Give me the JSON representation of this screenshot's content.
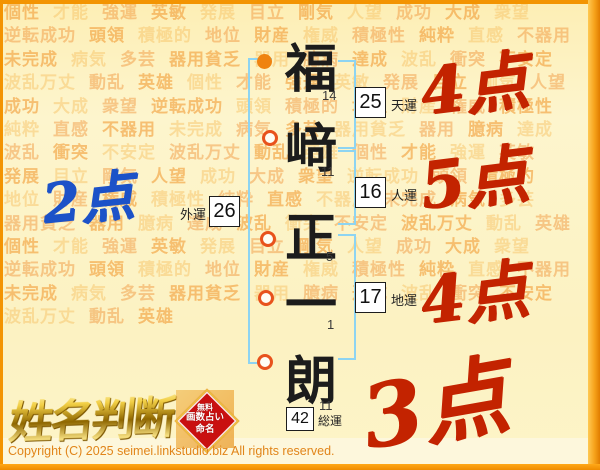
{
  "page": {
    "accent_orange": "#f39402",
    "bracket_blue": "#8dd4f2",
    "score_red": "#c32300",
    "score_blue": "#1c52c8",
    "seal_red": "#c91010"
  },
  "watermark": {
    "words": [
      "個性",
      "才能",
      "強運",
      "英敏",
      "発展",
      "目立",
      "剛気",
      "人望",
      "成功",
      "大成",
      "衆望",
      "逆転成功",
      "頭領",
      "積極的",
      "地位",
      "財産",
      "権威",
      "積極性",
      "純粋",
      "直感",
      "不器用",
      "未完成",
      "病気",
      "多芸",
      "器用貧乏",
      "器用",
      "臆病",
      "達成",
      "波乱",
      "衝突",
      "不安定",
      "波乱万丈",
      "動乱",
      "英雄"
    ],
    "repeat_count": 4
  },
  "name_chart": {
    "characters": [
      {
        "char": "福",
        "strokes": "14",
        "marker": "filled-circle"
      },
      {
        "char": "﨑",
        "strokes": "11",
        "marker": "open-circle"
      },
      {
        "char": "正",
        "strokes": "5",
        "marker": "open-circle"
      },
      {
        "char": "一",
        "strokes": "1",
        "marker": "open-circle"
      },
      {
        "char": "朗",
        "strokes": "11",
        "marker": "open-circle"
      }
    ],
    "fortunes": {
      "ten": {
        "label": "天運",
        "value": "25",
        "score": "4点"
      },
      "jin": {
        "label": "人運",
        "value": "16",
        "score": "5点"
      },
      "gai": {
        "label": "外運",
        "value": "26",
        "score": "2点"
      },
      "chi": {
        "label": "地運",
        "value": "17",
        "score": "4点"
      },
      "sou": {
        "label": "総運",
        "value": "42",
        "score": "3点"
      }
    }
  },
  "footer": {
    "logo_text": "姓名判断",
    "seal": {
      "lines": [
        "無料",
        "画数占い",
        "命名"
      ]
    },
    "copyright": "Copyright (C) 2025 seimei.linkstudio.biz All rights reserved."
  }
}
